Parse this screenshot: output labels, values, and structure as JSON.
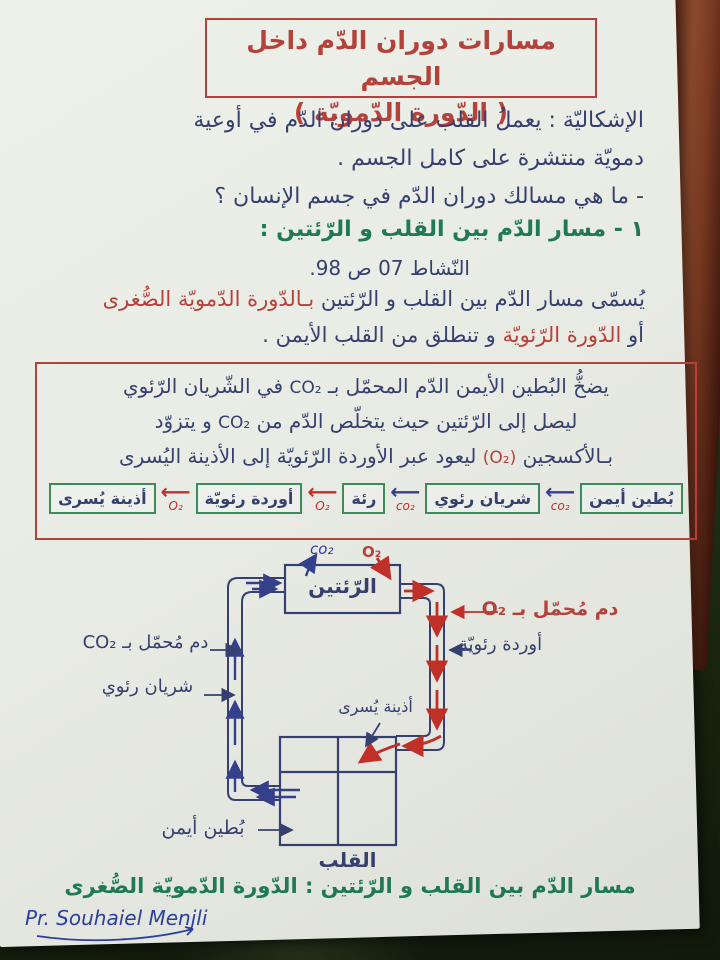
{
  "colors": {
    "red_ink": "#b5423a",
    "indigo_ink": "#36406e",
    "green_ink": "#1f7a52",
    "blue_ink": "#2a3f9e",
    "arrow_blue": "#35408a",
    "arrow_red": "#c03028",
    "box_green": "#3f8a5a",
    "paper": "#e9ebe5"
  },
  "title": {
    "line1": "مسارات دوران الدّم داخل الجسم",
    "line2": "( الدّورة الدّمويّة )"
  },
  "problem": {
    "line1": "الإشكاليّة : يعملُ القلب على دوران الدّم في أوعية",
    "line2": "دمويّة منتشرة على كامل الجسم .",
    "line3": "- ما هي مسالك دوران الدّم في جسم الإنسان ؟"
  },
  "section": {
    "heading": "١ - مسار الدّم بين القلب و الرّئتين :",
    "activity": "النّشاط 07 ص 98.",
    "naming_dark": "يُسمّى مسار الدّم بين القلب و الرّئتين",
    "naming_red": "بـالدّورة الدّمويّة الصُّغرى",
    "or_word": "أو",
    "or_red": "الدّورة الرّئويّة",
    "or_rest": "و تنطلق من القلب الأيمن ."
  },
  "definition": {
    "l1a": "يضخُّ البُطين الأيمن الدّم المحمّل بـ",
    "l1b": "CO₂",
    "l1c": "في الشّريان الرّئوي",
    "l2a": "ليصل إلى الرّئتين حيث يتخلّص الدّم من",
    "l2b": "CO₂",
    "l2c": "و يتزوّد",
    "l3a": "بـالأكسجين",
    "l3b": "(O₂)",
    "l3c": "ليعود عبر الأوردة الرّئويّة إلى الأذينة اليُسرى"
  },
  "flow": {
    "boxes": [
      "بُطين أيمن",
      "شريان رئوي",
      "رئة",
      "أوردة رئويّة",
      "أذينة يُسرى"
    ],
    "arrows": [
      {
        "label": "co₂",
        "color": "blue"
      },
      {
        "label": "co₂",
        "color": "blue"
      },
      {
        "label": "O₂",
        "color": "red"
      },
      {
        "label": "O₂",
        "color": "red"
      }
    ]
  },
  "diagram": {
    "lungs": "الرّئتين",
    "co2_top": "co₂",
    "o2_top": "O₂",
    "left_blood": "دم مُحمّل بـ CO₂",
    "left_vessel": "شريان رئوي",
    "right_blood": "دم مُحمّل بـ O₂",
    "right_vessel": "أوردة رئويّة",
    "left_atrium": "أذينة يُسرى",
    "right_ventricle": "بُطين أيمن",
    "heart": "القلب"
  },
  "caption": "مسار الدّم بين القلب و الرّئتين : الدّورة الدّمويّة الصُّغرى",
  "signature": "Pr. Souhaiel Menjli"
}
